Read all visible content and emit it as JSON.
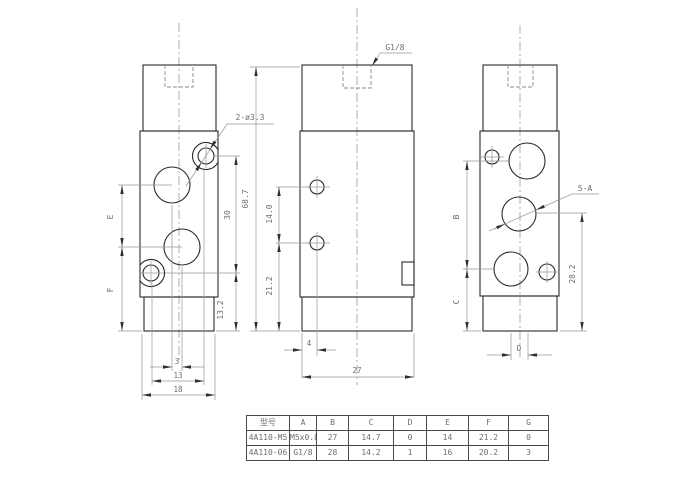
{
  "labels": {
    "port_thread": "G1/8",
    "mount_holes": "2-ø3.3",
    "ports": "5-A"
  },
  "dims": {
    "e": "E",
    "f": "F",
    "b": "B",
    "c": "C",
    "d": "D",
    "h30": "30",
    "h13_2": "13.2",
    "w3": "3",
    "w13": "13",
    "w18": "18",
    "h68_7": "68.7",
    "h14": "14.0",
    "h21_2": "21.2",
    "w4": "4",
    "w27": "27",
    "h28_2": "28.2"
  },
  "table": {
    "headers": [
      "型号",
      "A",
      "B",
      "C",
      "D",
      "E",
      "F",
      "G"
    ],
    "rows": [
      [
        "4A110-M5",
        "M5x0.8",
        "27",
        "14.7",
        "0",
        "14",
        "21.2",
        "0"
      ],
      [
        "4A110-06",
        "G1/8",
        "28",
        "14.2",
        "1",
        "16",
        "20.2",
        "3"
      ]
    ]
  }
}
